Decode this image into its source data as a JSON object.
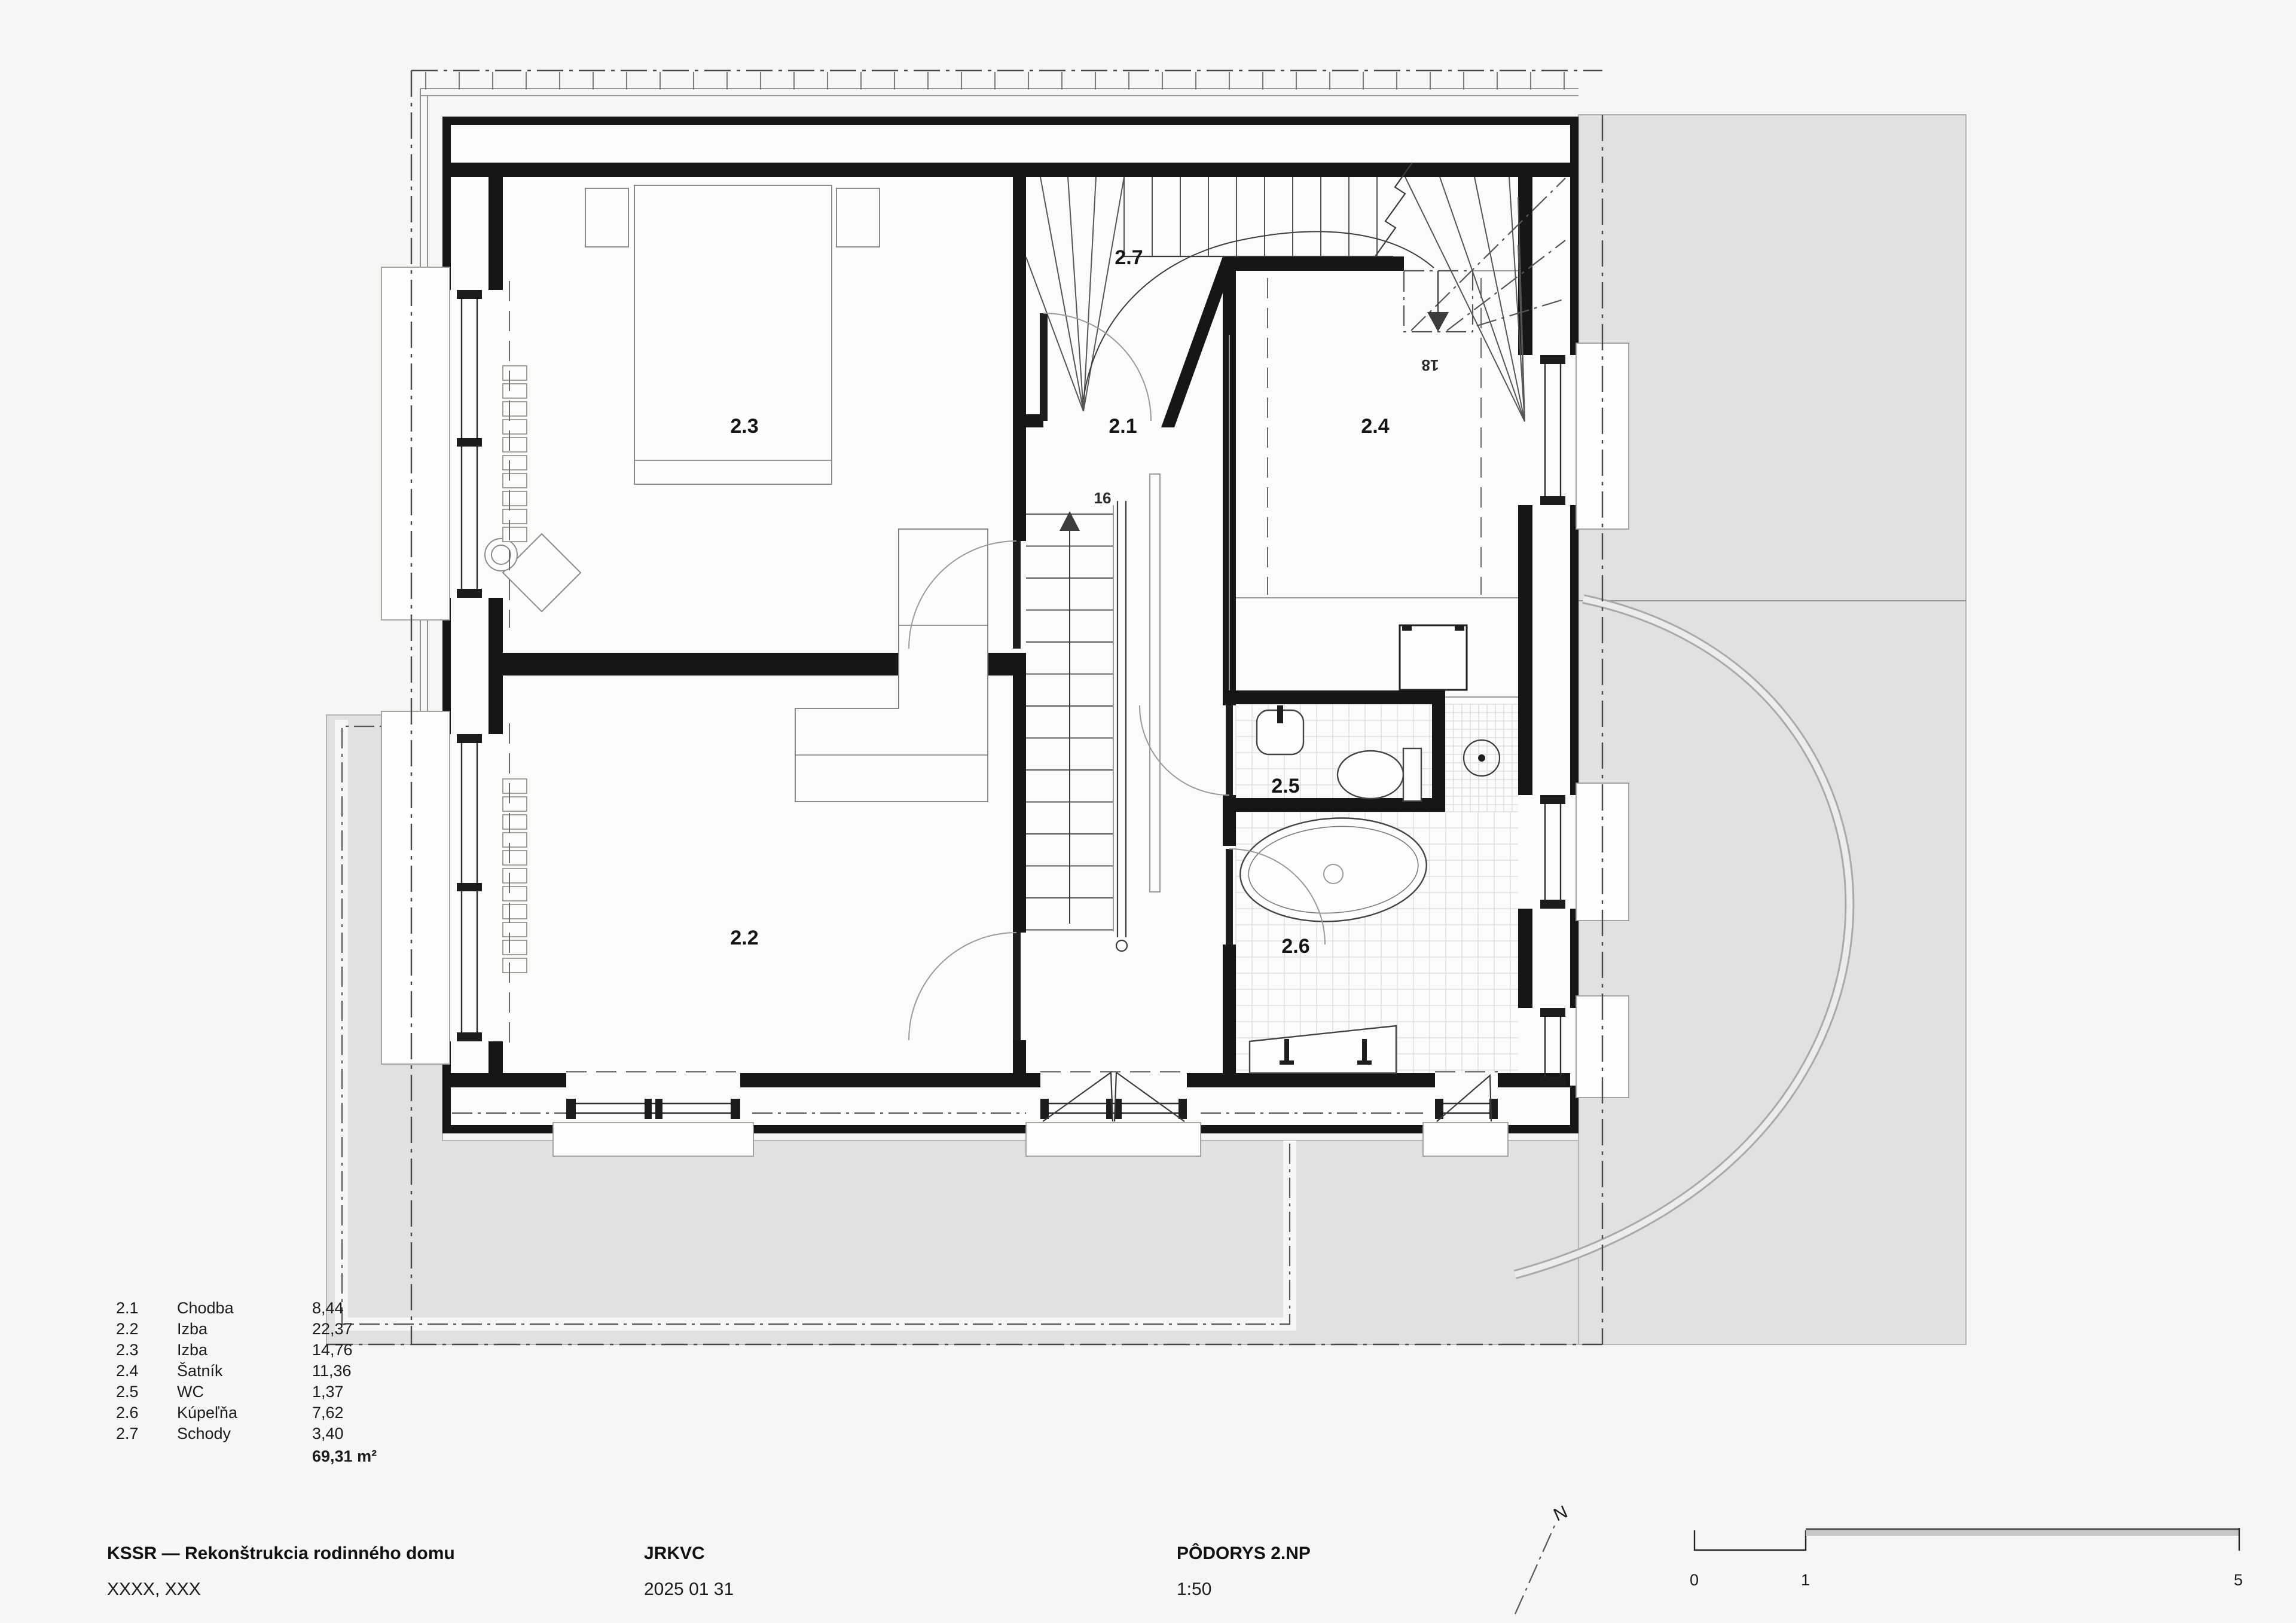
{
  "title_block": {
    "project": "KSSR — Rekonštrukcia rodinného domu",
    "location": "XXXX, XXX",
    "office": "JRKVC",
    "date": "2025 01 31",
    "drawing_title": "PÔDORYS 2.NP",
    "drawing_scale": "1:50"
  },
  "north": {
    "label": "N"
  },
  "scale_bar": {
    "tick0": "0",
    "tick1": "1",
    "tick5": "5"
  },
  "legend": {
    "rows": [
      {
        "id": "2.1",
        "name": "Chodba",
        "area": "8,44"
      },
      {
        "id": "2.2",
        "name": "Izba",
        "area": "22,37"
      },
      {
        "id": "2.3",
        "name": "Izba",
        "area": "14,76"
      },
      {
        "id": "2.4",
        "name": "Šatník",
        "area": "11,36"
      },
      {
        "id": "2.5",
        "name": "WC",
        "area": "1,37"
      },
      {
        "id": "2.6",
        "name": "Kúpeľňa",
        "area": "7,62"
      },
      {
        "id": "2.7",
        "name": "Schody",
        "area": "3,40"
      }
    ],
    "total": "69,31 m²"
  },
  "plan": {
    "rooms": [
      {
        "id": "2.1",
        "label": "2.1"
      },
      {
        "id": "2.2",
        "label": "2.2"
      },
      {
        "id": "2.3",
        "label": "2.3"
      },
      {
        "id": "2.4",
        "label": "2.4"
      },
      {
        "id": "2.5",
        "label": "2.5"
      },
      {
        "id": "2.6",
        "label": "2.6"
      },
      {
        "id": "2.7",
        "label": "2.7"
      }
    ],
    "stair_up_steps": "16",
    "stair_down_steps": "18"
  },
  "colors": {
    "background": "#f6f6f5",
    "site_gray": "#e1e1e0",
    "wall_black": "#161616"
  }
}
